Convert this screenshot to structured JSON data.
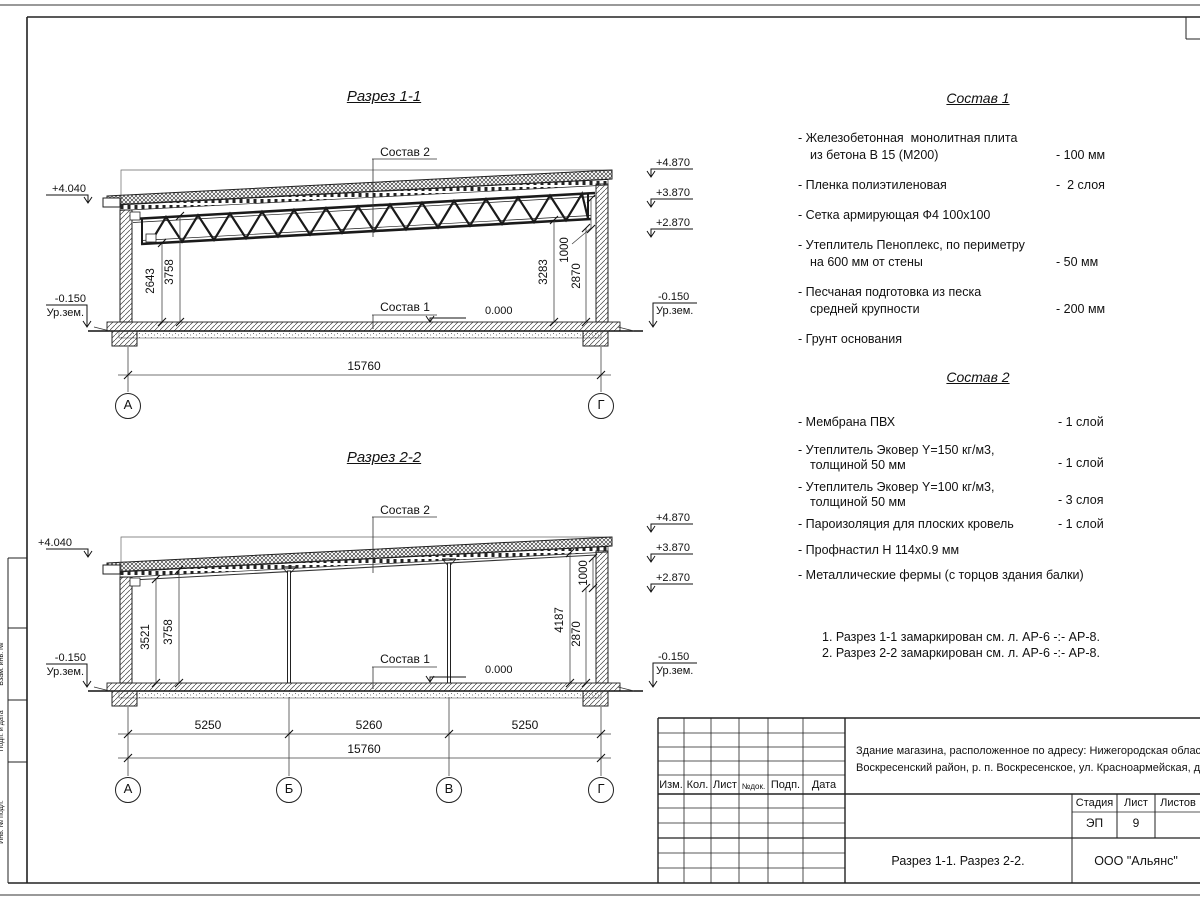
{
  "page": {
    "frame_side_labels": {
      "l1": "Взам. инв. №",
      "l2": "Подп. и дата",
      "l3": "Инв. № подл."
    }
  },
  "section1": {
    "title": "Разрез 1-1",
    "sostav2_label": "Состав 2",
    "sostav1_label": "Состав 1",
    "zero_mark": "0.000",
    "elev_left_top": "+4.040",
    "elev_left_bottom": "-0.150",
    "ground_label": "Ур.зем.",
    "elev_right_1": "+4.870",
    "elev_right_2": "+3.870",
    "elev_right_3": "+2.870",
    "elev_right_bottom": "-0.150",
    "dim_left_1": "2643",
    "dim_left_2": "3758",
    "dim_right_1": "3283",
    "dim_right_2": "1000",
    "dim_right_3": "2870",
    "dim_total": "15760",
    "axis_a": "А",
    "axis_g": "Г"
  },
  "section2": {
    "title": "Разрез 2-2",
    "sostav2_label": "Состав 2",
    "sostav1_label": "Состав 1",
    "zero_mark": "0.000",
    "elev_left_top": "+4.040",
    "elev_left_bottom": "-0.150",
    "ground_label": "Ур.зем.",
    "elev_right_1": "+4.870",
    "elev_right_2": "+3.870",
    "elev_right_3": "+2.870",
    "elev_right_bottom": "-0.150",
    "dim_left_1": "3521",
    "dim_left_2": "3758",
    "dim_right_1": "4187",
    "dim_right_2": "1000",
    "dim_right_3": "2870",
    "dim_span_1": "5250",
    "dim_span_2": "5260",
    "dim_span_3": "5250",
    "dim_total": "15760",
    "axis_a": "А",
    "axis_b": "Б",
    "axis_v": "В",
    "axis_g": "Г"
  },
  "sostav1": {
    "title": "Состав 1",
    "items": [
      {
        "l1": "- Железобетонная  монолитная плита",
        "l2": "из бетона В 15 (М200)",
        "val": "- 100 мм"
      },
      {
        "l1": "- Пленка полиэтиленовая",
        "val": "-  2 слоя"
      },
      {
        "l1": "- Сетка армирующая Ф4 100х100"
      },
      {
        "l1": "- Утеплитель Пеноплекс, по периметру",
        "l2": "на 600 мм от стены",
        "val": "- 50 мм"
      },
      {
        "l1": "- Песчаная подготовка из песка",
        "l2": "средней крупности",
        "val": "- 200 мм"
      },
      {
        "l1": "- Грунт основания"
      }
    ]
  },
  "sostav2": {
    "title": "Состав 2",
    "items": [
      {
        "l1": "- Мембрана ПВХ",
        "val": "- 1 слой"
      },
      {
        "l1": "- Утеплитель Эковер Y=150 кг/м3,",
        "l2": "толщиной 50 мм",
        "val": "- 1 слой"
      },
      {
        "l1": "- Утеплитель Эковер Y=100 кг/м3,",
        "l2": "толщиной 50 мм",
        "val": "- 3 слоя"
      },
      {
        "l1": "- Пароизоляция для плоских кровель",
        "val": "- 1 слой"
      },
      {
        "l1": "- Профнастил Н 114х0.9 мм"
      },
      {
        "l1": "- Металлические фермы (с торцов здания балки)"
      }
    ]
  },
  "notes": {
    "n1": "1. Разрез 1-1 замаркирован см. л. АР-6 -:- АР-8.",
    "n2": "2. Разрез 2-2 замаркирован см. л. АР-6 -:- АР-8."
  },
  "titleblock": {
    "col_izm": "Изм.",
    "col_kol": "Кол.",
    "col_list": "Лист",
    "col_ndok": "№док.",
    "col_podp": "Подп.",
    "col_data": "Дата",
    "desc_line1": "Здание магазина, расположенное по адресу: Нижегородская область",
    "desc_line2": "Воскресенский район, р. п. Воскресенское, ул. Красноармейская, д. 1",
    "stage_header": "Стадия",
    "sheet_header": "Лист",
    "sheets_header": "Листов",
    "stage_value": "ЭП",
    "sheet_value": "9",
    "drawing_title": "Разрез 1-1. Разрез 2-2.",
    "company": "ООО \"Альянс\""
  }
}
